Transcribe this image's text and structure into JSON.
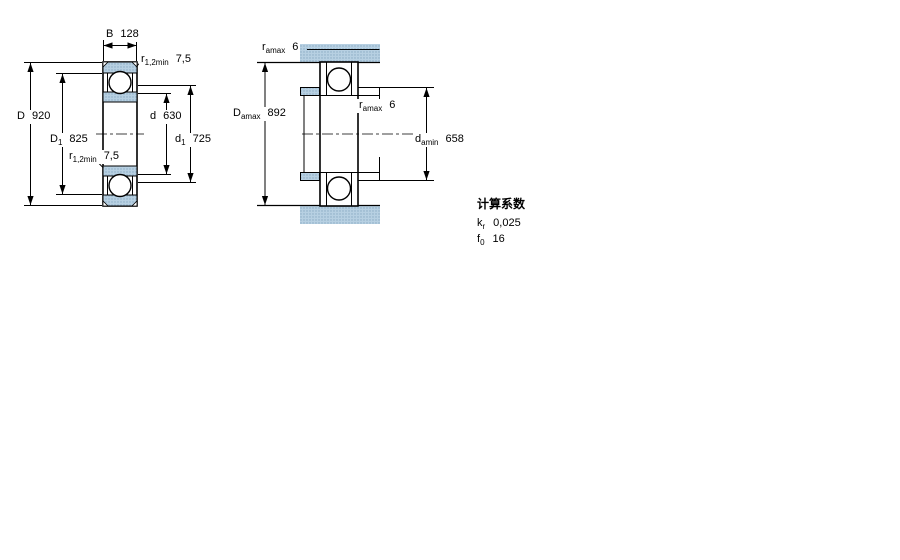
{
  "drawing": {
    "left_view": {
      "name": "bearing cross-section view",
      "dims": {
        "B": {
          "sym": "B",
          "val": "128"
        },
        "r_top": {
          "sym": "r",
          "sub": "1,2min",
          "val": "7,5"
        },
        "D": {
          "sym": "D",
          "val": "920"
        },
        "D1": {
          "sym": "D",
          "sub": "1",
          "val": "825"
        },
        "d": {
          "sym": "d",
          "val": "630"
        },
        "d1": {
          "sym": "d",
          "sub": "1",
          "val": "725"
        },
        "r_bottom": {
          "sym": "r",
          "sub": "1,2min",
          "val": "7,5"
        }
      }
    },
    "right_view": {
      "name": "abutment and fillet dimensions view",
      "dims": {
        "ra_top": {
          "sym": "r",
          "sub": "amax",
          "val": "6"
        },
        "Da": {
          "sym": "D",
          "sub": "amax",
          "val": "892"
        },
        "ra_mid": {
          "sym": "r",
          "sub": "amax",
          "val": "6"
        },
        "da": {
          "sym": "d",
          "sub": "amin",
          "val": "658"
        }
      }
    },
    "factors": {
      "heading": "计算系数",
      "rows": [
        {
          "sym": "k",
          "sub": "r",
          "val": "0,025"
        },
        {
          "sym": "f",
          "sub": "0",
          "val": "16"
        }
      ]
    },
    "colors": {
      "section_fill": "#b7d0e2",
      "section_dot": "#89aac3",
      "line": "#000000",
      "background": "#ffffff"
    }
  }
}
